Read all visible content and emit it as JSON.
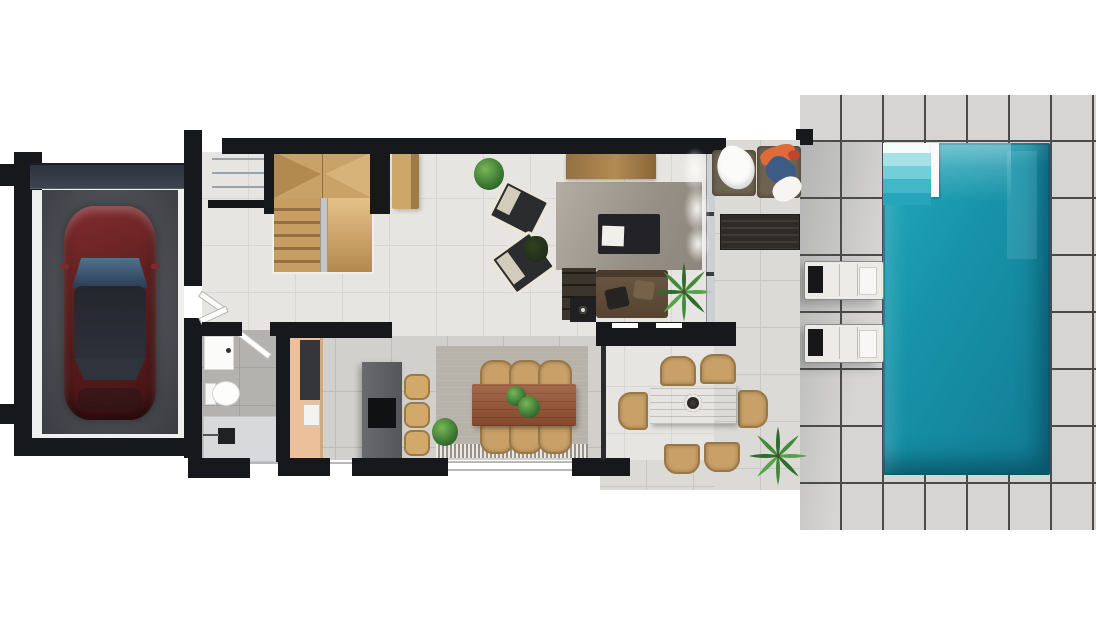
{
  "scene": {
    "description": "Top-down 3D rendered ground-floor plan of a villa with garage, entry stairs, bathroom, kitchen, living room, indoor and outdoor dining areas, lounge terrace, sun deck and swimming pool",
    "view": "top-down floor plan render",
    "visible_text": ""
  },
  "colors": {
    "wall": "#16181c",
    "paver": "#d6d5d3",
    "paver_line": "#4b4b49",
    "terrace": "#dbdad6",
    "floor_light": "#e7e5e1",
    "floor_gray": "#d2d0cc",
    "pool_water": "#1793a9",
    "pool_step": "#72cfd9",
    "car_body": "#61201f",
    "stair_wood": "#c9a267",
    "rug": "#968f85",
    "sofa": "#6a5844",
    "table_wood": "#9a5433",
    "chair_tan": "#c9a168",
    "island": "#54565a",
    "cabinet": "#ecc09a",
    "lounger": "#edebe7",
    "towel_orange": "#df6a3c",
    "towel_blue": "#3c5c86",
    "plant": "#3e7c35"
  },
  "rooms": {
    "garage": "Garage",
    "entry": "Entry steps",
    "staircase": "Staircase",
    "bathroom": "Bathroom",
    "kitchen": "Kitchen",
    "living_room": "Living room",
    "dining_area": "Dining area",
    "outdoor_dining": "Outdoor dining terrace",
    "lounge_terrace": "Lounge terrace",
    "pool_terrace": "Pool terrace",
    "pool": "Swimming pool"
  },
  "furniture": {
    "car": "Car",
    "sofa": "Sofa",
    "coffee_table": "Coffee table",
    "tv_console": "TV console",
    "armchair": "Armchair",
    "dining_table": "Dining table",
    "dining_chair": "Dining chair",
    "kitchen_island": "Kitchen island",
    "bar_stool": "Bar stool",
    "toilet": "Toilet",
    "vanity": "Vanity sink",
    "shower": "Shower",
    "sun_lounger": "Sun lounger",
    "lounge_chair": "Lounge chair",
    "outdoor_table": "Outdoor dining table",
    "palm_plant": "Palm plant",
    "pampas_plant": "Pampas plant"
  }
}
